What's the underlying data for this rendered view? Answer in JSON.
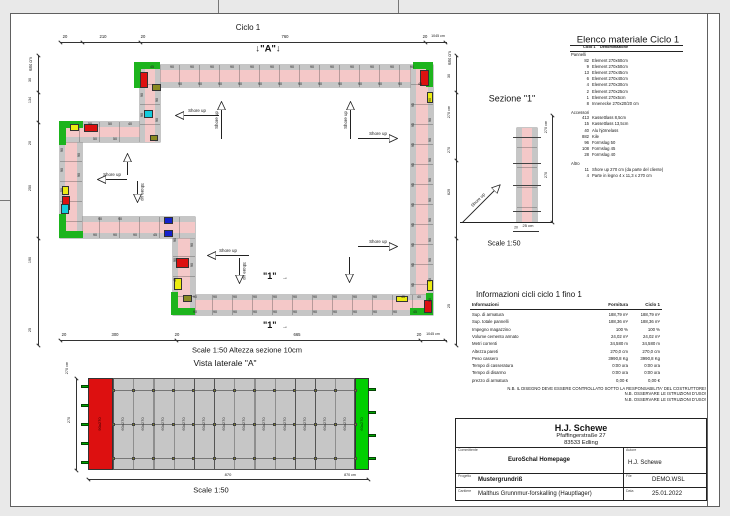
{
  "sheet": {
    "plan": {
      "title": "Ciclo 1",
      "marker_a": "↓\"A\"↓",
      "marker_1": "\"1\"",
      "marker_arrow": "→",
      "shore_up_label": "Shore up",
      "caption": "Scale 1:50   Altezza sezione 10cm",
      "panel_label": "90",
      "panel_small_labels": [
        "45",
        "40",
        "50"
      ],
      "dims": {
        "top": [
          "20",
          "210",
          "20",
          "760",
          "20",
          "1045 cm"
        ],
        "left": [
          "684 cm",
          "30",
          "134",
          "20",
          "250",
          "190",
          "25"
        ],
        "right": [
          "684 cm",
          "30",
          "270 cm",
          "270",
          "629",
          "25"
        ],
        "bottom": [
          "20",
          "300",
          "20",
          "665",
          "20",
          "1045 cm"
        ]
      }
    },
    "section1": {
      "title": "Sezione \"1\"",
      "shore_up_label": "Shore up",
      "dim_height_cm": "270 cm",
      "dim_height": "270",
      "dim_width": "25 cm",
      "dim_thickness": "20",
      "caption": "Scale 1:50"
    },
    "materials": {
      "title": "Elenco materiale  Ciclo 1",
      "col1": "Ciclo 1",
      "col2": "Denominazione",
      "groups": [
        {
          "name": "Pannelli",
          "items": [
            [
              "82",
              "Element 270x60cm"
            ],
            [
              "9",
              "Element 270x50cm"
            ],
            [
              "13",
              "Element 270x45cm"
            ],
            [
              "6",
              "Element 270x40cm"
            ],
            [
              "4",
              "Element 270x30cm"
            ],
            [
              "2",
              "Element 270x25cm"
            ],
            [
              "1",
              "Element 270x5cm"
            ],
            [
              "8",
              "Innenecke 270x20/20 cm"
            ]
          ]
        },
        {
          "name": "Accessori",
          "items": [
            [
              "413",
              "Kassettlass 8,5cm"
            ],
            [
              "15",
              "Kassettlass 13,5cm"
            ],
            [
              "40",
              "Alu hjörnelass"
            ],
            [
              "882",
              "Kile"
            ],
            [
              "96",
              "Formslag 50"
            ],
            [
              "108",
              "Formslag 45"
            ],
            [
              "28",
              "Formslag 40"
            ]
          ]
        },
        {
          "name": "Altro",
          "items": [
            [
              "11",
              "Shore up 270 cm (da parte del cliente)"
            ],
            [
              "4",
              "Parte in legno 4 x 11,3 x 270 cm"
            ]
          ]
        }
      ]
    },
    "info": {
      "title": "Informazioni cicli  ciclo 1 fino 1",
      "headers": [
        "Informazioni",
        "Fornitura",
        "Ciclo 1"
      ],
      "rows": [
        [
          "Sup. di armatura",
          "188,79 m²",
          "188,79 m²"
        ],
        [
          "Sup. totale pannelli",
          "188,36 m²",
          "188,36 m²"
        ],
        [
          "Impegno magazzino",
          "100 %",
          "100 %"
        ],
        [
          "Volume cemento armato",
          "24,02 m³",
          "24,02 m³"
        ],
        [
          "Metri correnti",
          "34,580 m",
          "34,580 m"
        ],
        [
          "Altezza pareti",
          "270,0 cm",
          "270,0 cm"
        ],
        [
          "Peso cassero",
          "3990,8 Kg",
          "3990,8 Kg"
        ],
        [
          "Tempo di casseratura",
          "0:00 ora",
          "0:00 ora"
        ],
        [
          "Tempo di disarmo",
          "0:00 ora",
          "0:00 ora"
        ],
        [
          "prezzo di armatura",
          "0,00 €",
          "0,00 €"
        ]
      ],
      "notes": [
        "N.B. IL DISEGNO DEVE ESSERE CONTROLLATO SOTTO LA RESPONSABILITA' DEL COSTRUTTORE!",
        "N.B. OSSERVARE LE ISTRUZIONI D'USO!",
        "N.B. OSSERVARE LE ISTRUZIONI D'USO!"
      ]
    },
    "titleblock": {
      "company": "H.J. Schewe",
      "address1": "Pfaffingerstraße 27",
      "address2": "83533 Edling",
      "committente_label": "Committente",
      "committente": "EuroSchal Homepage",
      "autore_label": "Autore",
      "autore": "H.J. Schewe",
      "progetto_label": "Progetto",
      "progetto": "Mustergrundriß",
      "file_label": "File",
      "file": "DEMO.WSL",
      "cantiere_label": "Cantiere",
      "cantiere": "Malthus Grunnmur-forskalling (Hauptlager)",
      "data_label": "Data",
      "data": "25.01.2022"
    },
    "lateral": {
      "title": "Vista laterale \"A\"",
      "panel_label": "60x270",
      "red_panel_label": "90x270",
      "dim_height_cm": "270 cm",
      "dim_height": "270",
      "dim_width": "870",
      "dim_width_cm": "870 cm",
      "caption": "Scale 1:50"
    },
    "colors": {
      "wall_pink": "#f4c8c8",
      "panel_gray": "#c6c6c6",
      "corner_green": "#1db41d",
      "piece_red": "#dd1010",
      "piece_yellow": "#ecec12",
      "piece_cyan": "#14ccdd",
      "piece_blue": "#1522cc",
      "piece_olive": "#8a8a22"
    }
  }
}
